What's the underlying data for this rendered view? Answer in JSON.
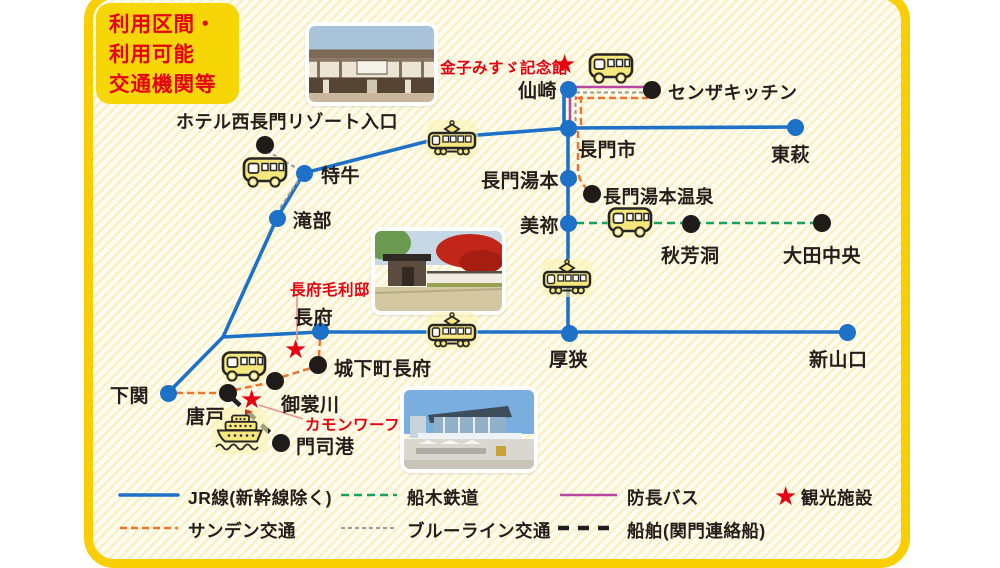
{
  "info_box": {
    "line1": "利用区間・",
    "line2": "利用可能",
    "line3": "交通機関等"
  },
  "colors": {
    "frame_gold": "#f9ce03",
    "info_box_yellow": "#f6d607",
    "red_text": "#e60012",
    "jr_blue": "#1d71c7",
    "sanden_orange": "#ee7331",
    "funaki_green": "#17a05c",
    "blueline_gray": "#9a9a9a",
    "bocho_magenta": "#b8479f",
    "ship_black": "#1f1f1f",
    "station_black": "#1f1b18"
  },
  "line_styles": {
    "jr": {
      "color": "#1d71c7",
      "width": 3.6,
      "dash": null,
      "cap": "round"
    },
    "sanden": {
      "color": "#ee7331",
      "width": 2.5,
      "dash": "7,4",
      "cap": "butt"
    },
    "funaki": {
      "color": "#17a05c",
      "width": 2.6,
      "dash": "8,5",
      "cap": "butt"
    },
    "blueline": {
      "color": "#9a9a9a",
      "width": 2.1,
      "dash": "4,3",
      "cap": "butt"
    },
    "bocho": {
      "color": "#b8479f",
      "width": 2.6,
      "dash": null,
      "cap": "butt"
    },
    "ship": {
      "color": "#1f1f1f",
      "width": 4.6,
      "dash": "11,9",
      "cap": "butt"
    },
    "leader": {
      "color": "#e8928a",
      "width": 1.6,
      "dash": null,
      "cap": "butt"
    }
  },
  "routes": [
    {
      "name": "jr-senzaki-branch",
      "line": "jr",
      "path": "M564,92 L564,126"
    },
    {
      "name": "jr-sanin-east",
      "line": "jr",
      "path": "M568,128 L795,127"
    },
    {
      "name": "jr-sanin-west",
      "line": "jr",
      "path": "M568,128 L440,138 L304,173"
    },
    {
      "name": "jr-sanin-southwest",
      "line": "jr",
      "path": "M304,173 L277,218 L223,337 L168,393"
    },
    {
      "name": "jr-sanyo",
      "line": "jr",
      "path": "M223,337 L320,332 L847,332"
    },
    {
      "name": "jr-mine-line",
      "line": "jr",
      "path": "M568,128 L568,333"
    },
    {
      "name": "bocho-senzaki-h",
      "line": "bocho",
      "path": "M574,87 L650,87"
    },
    {
      "name": "bocho-senzaki-v",
      "line": "bocho",
      "path": "M570,93 L570,126"
    },
    {
      "name": "blueline-senzaki-h",
      "line": "blueline",
      "path": "M576,92.5 L646,92.5"
    },
    {
      "name": "blueline-senzaki-v",
      "line": "blueline",
      "path": "M575.5,96 L575.5,126"
    },
    {
      "name": "sanden-senzaki-h",
      "line": "sanden",
      "path": "M576,98 L648,98"
    },
    {
      "name": "sanden-senzaki-v",
      "line": "sanden",
      "path": "M581,96 L581,126"
    },
    {
      "name": "sanden-yumoto",
      "line": "sanden",
      "path": "M578,131 L578,168 Q578,183 590,191"
    },
    {
      "name": "funaki-akiyoshi",
      "line": "funaki",
      "path": "M576,223 L814,223"
    },
    {
      "name": "blueline-hotel",
      "line": "blueline",
      "path": "M267,151 L298,169"
    },
    {
      "name": "blueline-takibe",
      "line": "blueline",
      "path": "M298,181 L272,220"
    },
    {
      "name": "sanden-shimonoseki",
      "line": "sanden",
      "path": "M176,393 L221,393"
    },
    {
      "name": "sanden-karato",
      "line": "sanden",
      "path": "M234,390 L268,383"
    },
    {
      "name": "sanden-mimosuso",
      "line": "sanden",
      "path": "M282,377 L311,368"
    },
    {
      "name": "sanden-chofu",
      "line": "sanden",
      "path": "M319,357 L320,338"
    },
    {
      "name": "ship-kanmon",
      "line": "ship",
      "path": "M232,398 L278,440"
    },
    {
      "name": "leader-mori",
      "line": "leader",
      "path": "M297,295 L297,340"
    },
    {
      "name": "leader-kamon",
      "line": "leader",
      "path": "M259,405 L303,419"
    }
  ],
  "stations": [
    {
      "name": "senzaki",
      "label": "仙崎",
      "type": "jr",
      "x": 568,
      "y": 89,
      "lx": 518,
      "ly": 76
    },
    {
      "name": "nagatoshi",
      "label": "長門市",
      "type": "jr",
      "x": 568,
      "y": 128,
      "lx": 578,
      "ly": 135
    },
    {
      "name": "higashi-hagi",
      "label": "東萩",
      "type": "jr",
      "x": 795,
      "y": 127,
      "lx": 771,
      "ly": 140
    },
    {
      "name": "nagato-yumoto",
      "label": "長門湯本",
      "type": "jr",
      "x": 568,
      "y": 178,
      "lx": 481,
      "ly": 166
    },
    {
      "name": "mine",
      "label": "美祢",
      "type": "jr",
      "x": 568,
      "y": 223,
      "lx": 520,
      "ly": 211
    },
    {
      "name": "asa",
      "label": "厚狭",
      "type": "jr",
      "x": 569,
      "y": 333,
      "lx": 549,
      "ly": 345
    },
    {
      "name": "shin-yamaguchi",
      "label": "新山口",
      "type": "jr",
      "x": 847,
      "y": 332,
      "lx": 809,
      "ly": 345
    },
    {
      "name": "kottoi",
      "label": "特牛",
      "type": "jr",
      "x": 304,
      "y": 173,
      "lx": 321,
      "ly": 161
    },
    {
      "name": "takibe",
      "label": "滝部",
      "type": "jr",
      "x": 277,
      "y": 218,
      "lx": 293,
      "ly": 206
    },
    {
      "name": "chofu",
      "label": "長府",
      "type": "jr",
      "x": 320,
      "y": 331,
      "lx": 294,
      "ly": 303
    },
    {
      "name": "shimonoseki",
      "label": "下関",
      "type": "jr",
      "x": 168,
      "y": 393,
      "lx": 110,
      "ly": 381
    },
    {
      "name": "senza-kitchen",
      "label": "センザキッチン",
      "type": "stop",
      "x": 652,
      "y": 90,
      "lx": 668,
      "ly": 79,
      "fs": 18
    },
    {
      "name": "yumoto-onsen",
      "label": "長門湯本温泉",
      "type": "stop",
      "x": 592,
      "y": 194,
      "lx": 603,
      "ly": 183,
      "fs": 18
    },
    {
      "name": "akiyoshido",
      "label": "秋芳洞",
      "type": "stop",
      "x": 691,
      "y": 224,
      "lx": 661,
      "ly": 241
    },
    {
      "name": "ota-chuo",
      "label": "大田中央",
      "type": "stop",
      "x": 822,
      "y": 223,
      "lx": 783,
      "ly": 241
    },
    {
      "name": "hotel-nishinagato",
      "label": "ホテル西長門リゾート入口",
      "type": "stop",
      "x": 265,
      "y": 145,
      "lx": 176,
      "ly": 108,
      "fs": 18
    },
    {
      "name": "jokamachi-chofu",
      "label": "城下町長府",
      "type": "stop",
      "x": 318,
      "y": 365,
      "lx": 334,
      "ly": 354
    },
    {
      "name": "mimosusogawa",
      "label": "御裳川",
      "type": "stop",
      "x": 275,
      "y": 381,
      "lx": 281,
      "ly": 390
    },
    {
      "name": "karato",
      "label": "唐戸",
      "type": "stop",
      "x": 228,
      "y": 393,
      "lx": 186,
      "ly": 402
    },
    {
      "name": "mojiko",
      "label": "門司港",
      "type": "stop",
      "x": 281,
      "y": 443,
      "lx": 296,
      "ly": 432
    }
  ],
  "attractions": [
    {
      "name": "kaneko-misuzu-kinenkan",
      "label": "金子みすゞ記念館",
      "star_x": 566,
      "star_y": 65,
      "lx": 440,
      "ly": 56
    },
    {
      "name": "chofu-mori-tei",
      "label": "長府毛利邸",
      "star_x": 297,
      "star_y": 350,
      "lx": 290,
      "ly": 278
    },
    {
      "name": "kamon-wharf",
      "label": "カモンワーフ",
      "star_x": 253,
      "star_y": 400,
      "lx": 305,
      "ly": 413
    }
  ],
  "legend": {
    "items": [
      {
        "name": "jr",
        "label": "JR線(新幹線除く)",
        "line": "jr",
        "x1": 120,
        "x2": 178,
        "y": 495,
        "lx": 188,
        "ly": 485
      },
      {
        "name": "funaki",
        "label": "船木鉄道",
        "line": "funaki",
        "x1": 341,
        "x2": 397,
        "y": 495,
        "lx": 407,
        "ly": 485
      },
      {
        "name": "bocho",
        "label": "防長バス",
        "line": "bocho",
        "x1": 560,
        "x2": 617,
        "y": 495,
        "lx": 627,
        "ly": 485
      },
      {
        "name": "kanko",
        "label": "観光施設",
        "star": true,
        "sx": 787,
        "sy": 496,
        "lx": 801,
        "ly": 485
      },
      {
        "name": "sanden",
        "label": "サンデン交通",
        "line": "sanden",
        "x1": 120,
        "x2": 178,
        "y": 528,
        "lx": 188,
        "ly": 518
      },
      {
        "name": "blueline",
        "label": "ブルーライン交通",
        "line": "blueline",
        "x1": 341,
        "x2": 397,
        "y": 528,
        "lx": 407,
        "ly": 518
      },
      {
        "name": "ship",
        "label": "船舶(関門連絡船)",
        "line": "ship",
        "x1": 558,
        "x2": 618,
        "y": 528,
        "lx": 627,
        "ly": 518
      }
    ]
  },
  "icons": {
    "buses": [
      {
        "name": "bus-hotel",
        "x": 265,
        "y": 172
      },
      {
        "name": "bus-senzaki",
        "x": 611,
        "y": 68
      },
      {
        "name": "bus-akiyoshi",
        "x": 630,
        "y": 222
      },
      {
        "name": "bus-karato",
        "x": 244,
        "y": 366
      }
    ],
    "trams": [
      {
        "name": "tram-nagatoshi",
        "x": 452,
        "y": 139
      },
      {
        "name": "tram-mine",
        "x": 567,
        "y": 278
      },
      {
        "name": "tram-chofu",
        "x": 452,
        "y": 331
      }
    ],
    "ferry": {
      "name": "ferry-kanmon",
      "x": 240,
      "y": 431
    }
  },
  "photos": [
    {
      "kind": "machiya",
      "x": 305,
      "y": 22,
      "w": 125,
      "h": 76
    },
    {
      "kind": "mori-gate",
      "x": 371,
      "y": 227,
      "w": 127,
      "h": 80
    },
    {
      "kind": "kamon-wharf",
      "x": 400,
      "y": 386,
      "w": 130,
      "h": 79
    }
  ]
}
